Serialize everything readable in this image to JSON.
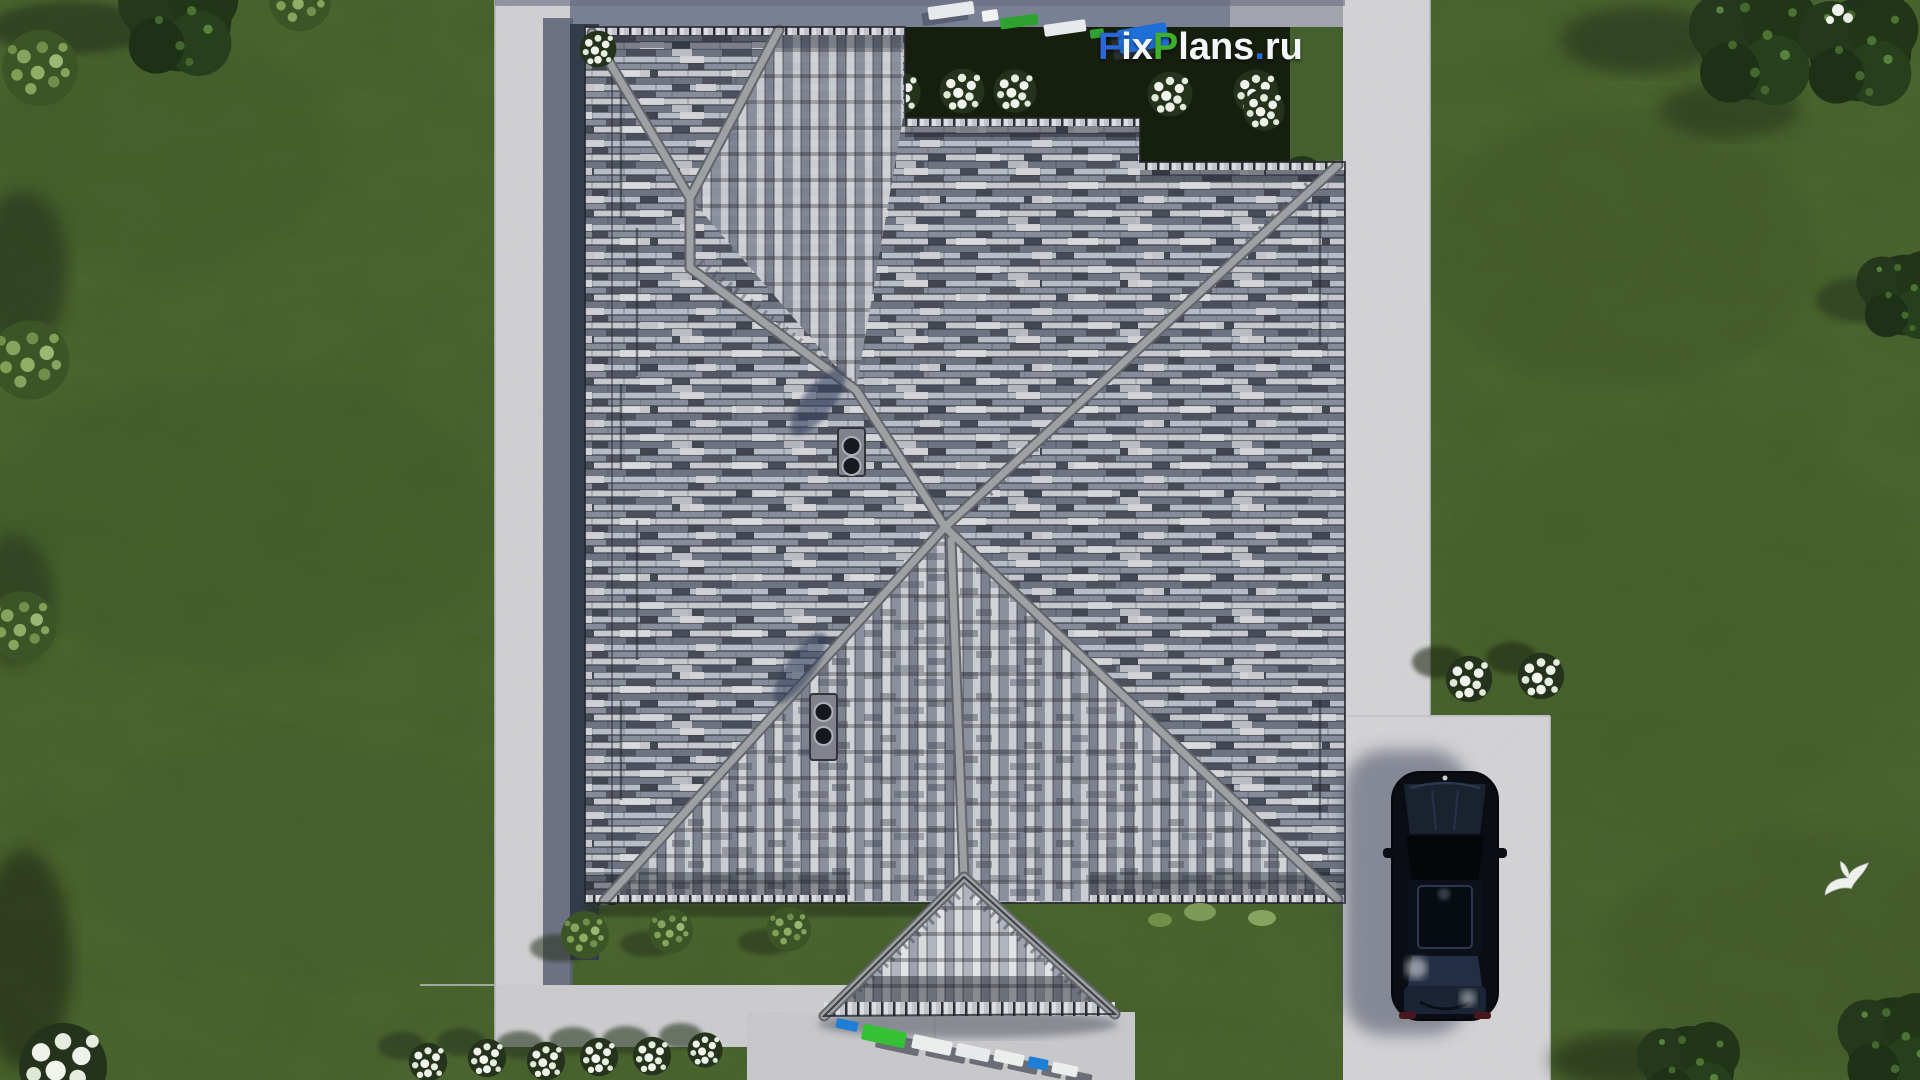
{
  "watermark": {
    "text": "FixPlans.ru",
    "segments": [
      {
        "text": "F",
        "color": "#2b66d9"
      },
      {
        "text": "ix",
        "color": "#f4f5f7"
      },
      {
        "text": "P",
        "color": "#3fae2a"
      },
      {
        "text": "lans",
        "color": "#f4f5f7"
      },
      {
        "text": ".",
        "color": "#2b66d9"
      },
      {
        "text": "ru",
        "color": "#f4f5f7"
      }
    ]
  },
  "palette": {
    "grass": "#4e6933",
    "grass_dark": "#3d5628",
    "concrete_path": "#d3d3d5",
    "road_shadow": "#7a8093",
    "hedge_dark": "#151e0d",
    "roof_tile_light": "#c9cbd1",
    "roof_tile_mid": "#8d92a0",
    "roof_tile_dark": "#3b3f4a",
    "roof_ridge": "#9fa0a3",
    "car_body": "#0a0d13",
    "watermark_green": "#35c135",
    "watermark_blue": "#1f6fd8",
    "flowers_white": "#eef2ea"
  },
  "scene": {
    "label": "aerial-top-view-house-roof-render"
  }
}
